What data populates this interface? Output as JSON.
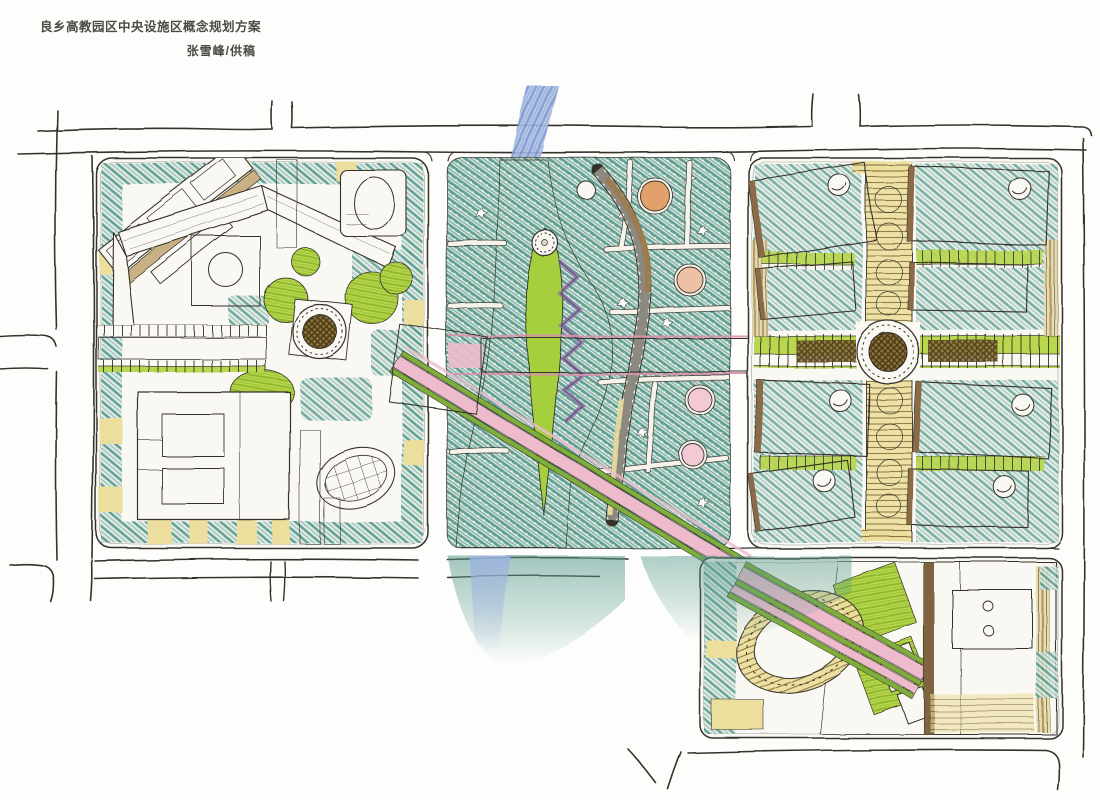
{
  "header": {
    "title": "良乡高教园区中央设施区概念规划方案",
    "byline": "张雪峰/供稿"
  },
  "palette": {
    "paper": "#fdfdfb",
    "paper2": "#faf8f2",
    "ink": "#35312a",
    "teal": "#579a8c",
    "tealDark": "#2f6f60",
    "tealBg": "#ddeae4",
    "river": "#7b97d2",
    "riverLight": "#b3c3e6",
    "lawn": "#b9d74d",
    "lawnLine": "#8fb92d",
    "island": "#a6cf3d",
    "pink": "#eebbcd",
    "pinkLine": "#d98fae",
    "plaidRed": "#b5504f",
    "cream": "#ecdf9e",
    "tan": "#c9b183",
    "brown": "#8a6b46",
    "darkBrown": "#6b5a33",
    "olive": "#7fae3a",
    "purple": "#8d6bb0",
    "peach": "#e2a06a",
    "blush": "#f2c9d4"
  }
}
